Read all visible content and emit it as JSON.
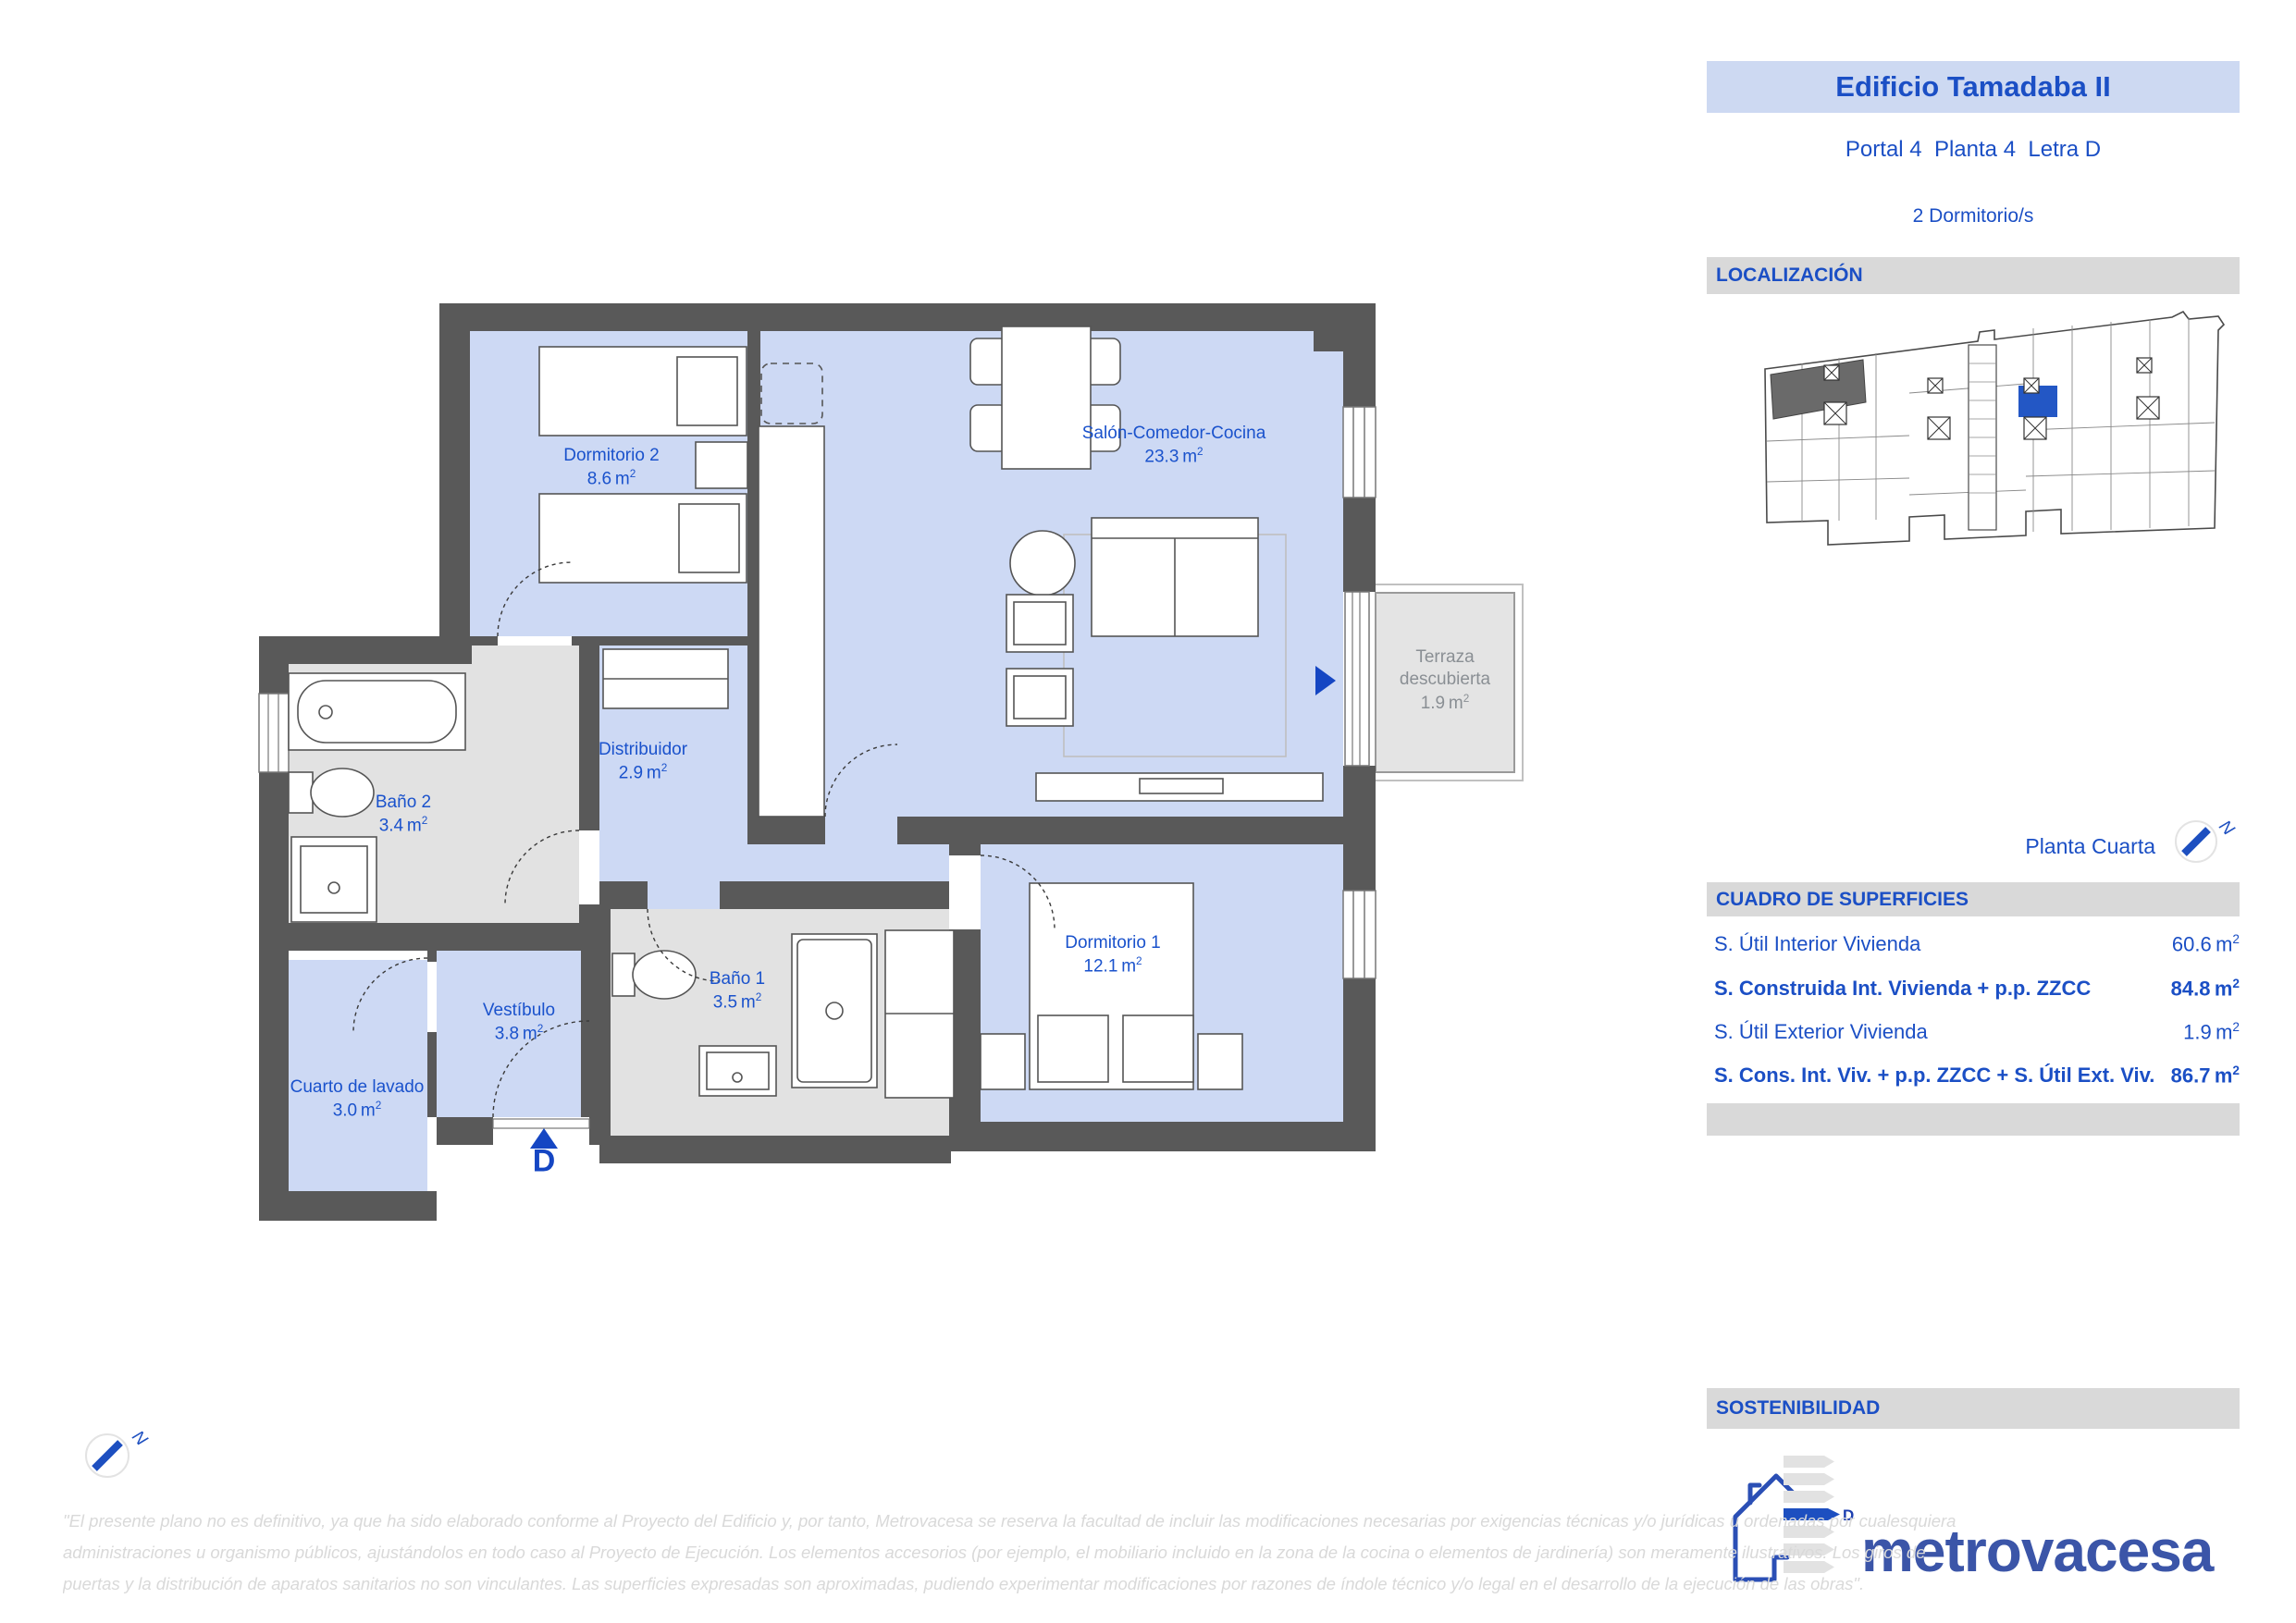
{
  "header": {
    "title": "Edificio Tamadaba II",
    "subtitle": "Portal 4  Planta 4  Letra D",
    "bedrooms": "2 Dormitorio/s"
  },
  "sections": {
    "localizacion": "LOCALIZACIÓN",
    "cuadro": "CUADRO DE SUPERFICIES",
    "sostenibilidad": "SOSTENIBILIDAD"
  },
  "floor_name": "Planta Cuarta",
  "compass_letter": "N",
  "entrance_letter": "D",
  "surfaces": {
    "unit": "m",
    "sup": "2",
    "rows": [
      {
        "label": "S. Útil Interior Vivienda",
        "value": "60.6"
      },
      {
        "label": "S. Construida Int. Vivienda + p.p. ZZCC",
        "value": "84.8"
      },
      {
        "label": "S. Útil Exterior Vivienda",
        "value": "1.9"
      },
      {
        "label": "S. Cons. Int. Viv. + p.p. ZZCC + S. Útil Ext. Viv.",
        "value": "86.7"
      }
    ]
  },
  "plan": {
    "unit": "m",
    "sup": "2",
    "rooms": [
      {
        "name": "Dormitorio 2",
        "name2": "",
        "area": "8.6"
      },
      {
        "name": "Salón-Comedor-Cocina",
        "name2": "",
        "area": "23.3"
      },
      {
        "name": "Terraza",
        "name2": "descubierta",
        "area": "1.9"
      },
      {
        "name": "Distribuidor",
        "name2": "",
        "area": "2.9"
      },
      {
        "name": "Baño 2",
        "name2": "",
        "area": "3.4"
      },
      {
        "name": "Vestíbulo",
        "name2": "",
        "area": "3.8"
      },
      {
        "name": "Cuarto de lavado",
        "name2": "",
        "area": "3.0"
      },
      {
        "name": "Baño 1",
        "name2": "",
        "area": "3.5"
      },
      {
        "name": "Dormitorio 1",
        "name2": "",
        "area": "12.1"
      }
    ]
  },
  "energy_label": {
    "letter": "D"
  },
  "brand": {
    "name": "metrovacesa"
  },
  "disclaimer": {
    "line1": "\"El presente plano no es definitivo, ya que ha sido elaborado conforme al Proyecto del Edificio y, por tanto, Metrovacesa se reserva la facultad de incluir las modificaciones necesarias por exigencias técnicas y/o jurídicas u ordenadas por cualesquiera",
    "line2": "administraciones u organismo públicos, ajustándolos en todo caso al Proyecto de Ejecución. Los elementos accesorios (por ejemplo, el mobiliario incluido en la zona de la cocina o elementos de jardinería) son meramente ilustrativos. Los giros de",
    "line3": "puertas y la distribución de aparatos sanitarios no son vinculantes. Las superficies expresadas son aproximadas, pudiendo experimentar modificaciones por razones de índole técnico y/o legal en el desarrollo de la ejecución de las obras\"."
  },
  "colors": {
    "accent_blue": "#1b4fc5",
    "floor_blue": "#cdd9f4",
    "wall_gray": "#595959",
    "bath_floor_gray": "#e2e2e2",
    "band_gray": "#d9d9d9",
    "header_band_blue": "#cdd9f2",
    "terrace_gray": "#e4e4e4",
    "highlight_unit_blue": "#2357c5",
    "logo_blue": "#3b55a8",
    "disclaimer_gray": "#d9d9d9"
  }
}
